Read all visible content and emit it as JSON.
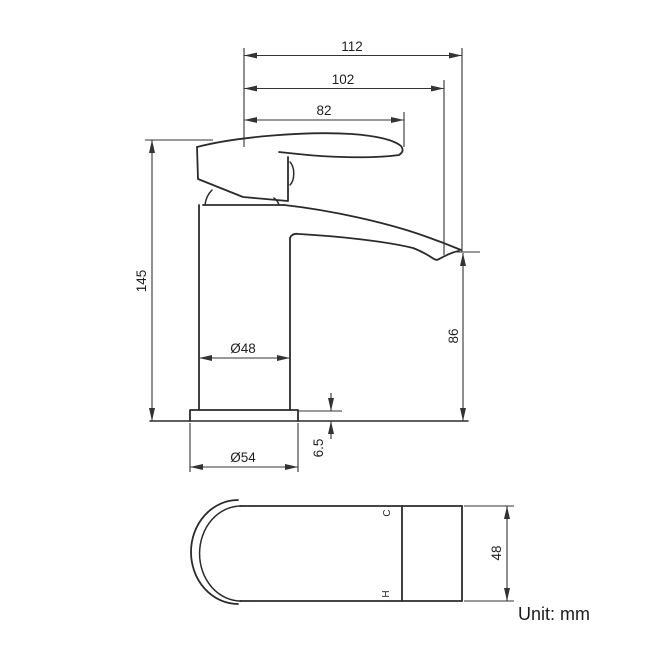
{
  "colors": {
    "line": "#2b2b2b",
    "text": "#1f1f1f",
    "background": "#ffffff"
  },
  "unit_label": "Unit: mm",
  "side_view": {
    "dimensions": {
      "total_reach": "112",
      "spout_reach": "102",
      "handle_reach": "82",
      "total_height": "145",
      "spout_height": "86",
      "body_diameter": "Ø48",
      "base_diameter": "Ø54",
      "base_plate_height": "6.5"
    }
  },
  "plan_view": {
    "dimensions": {
      "body_width": "48"
    },
    "indicators": {
      "cold": "C",
      "hot": "H"
    }
  }
}
